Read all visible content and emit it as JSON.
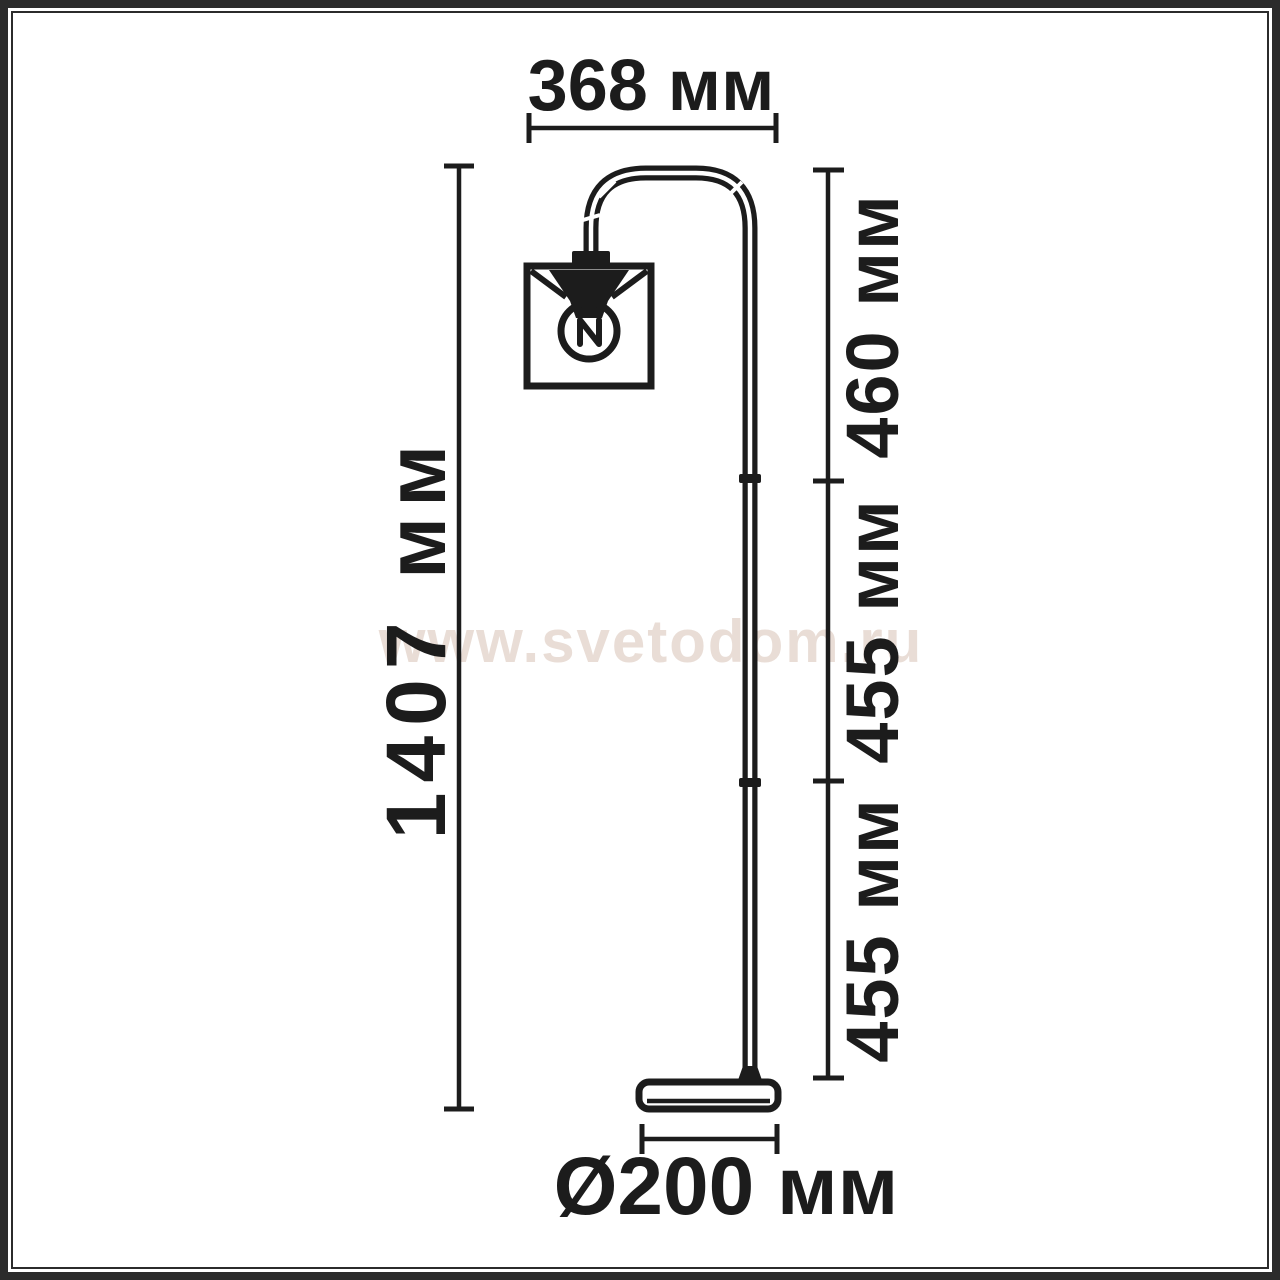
{
  "colors": {
    "ink": "#1c1c1c",
    "frame": "#2b2b2b",
    "background": "#ffffff",
    "watermark": "#e9ddd6"
  },
  "watermark": {
    "text": "www.svetodom.ru"
  },
  "dimensions": {
    "top_width": "368 мм",
    "total_height": "1407 мм",
    "upper_segment": "460 мм",
    "middle_segment": "455 мм",
    "lower_segment": "455 мм",
    "base_diameter": "Ø200 мм"
  }
}
